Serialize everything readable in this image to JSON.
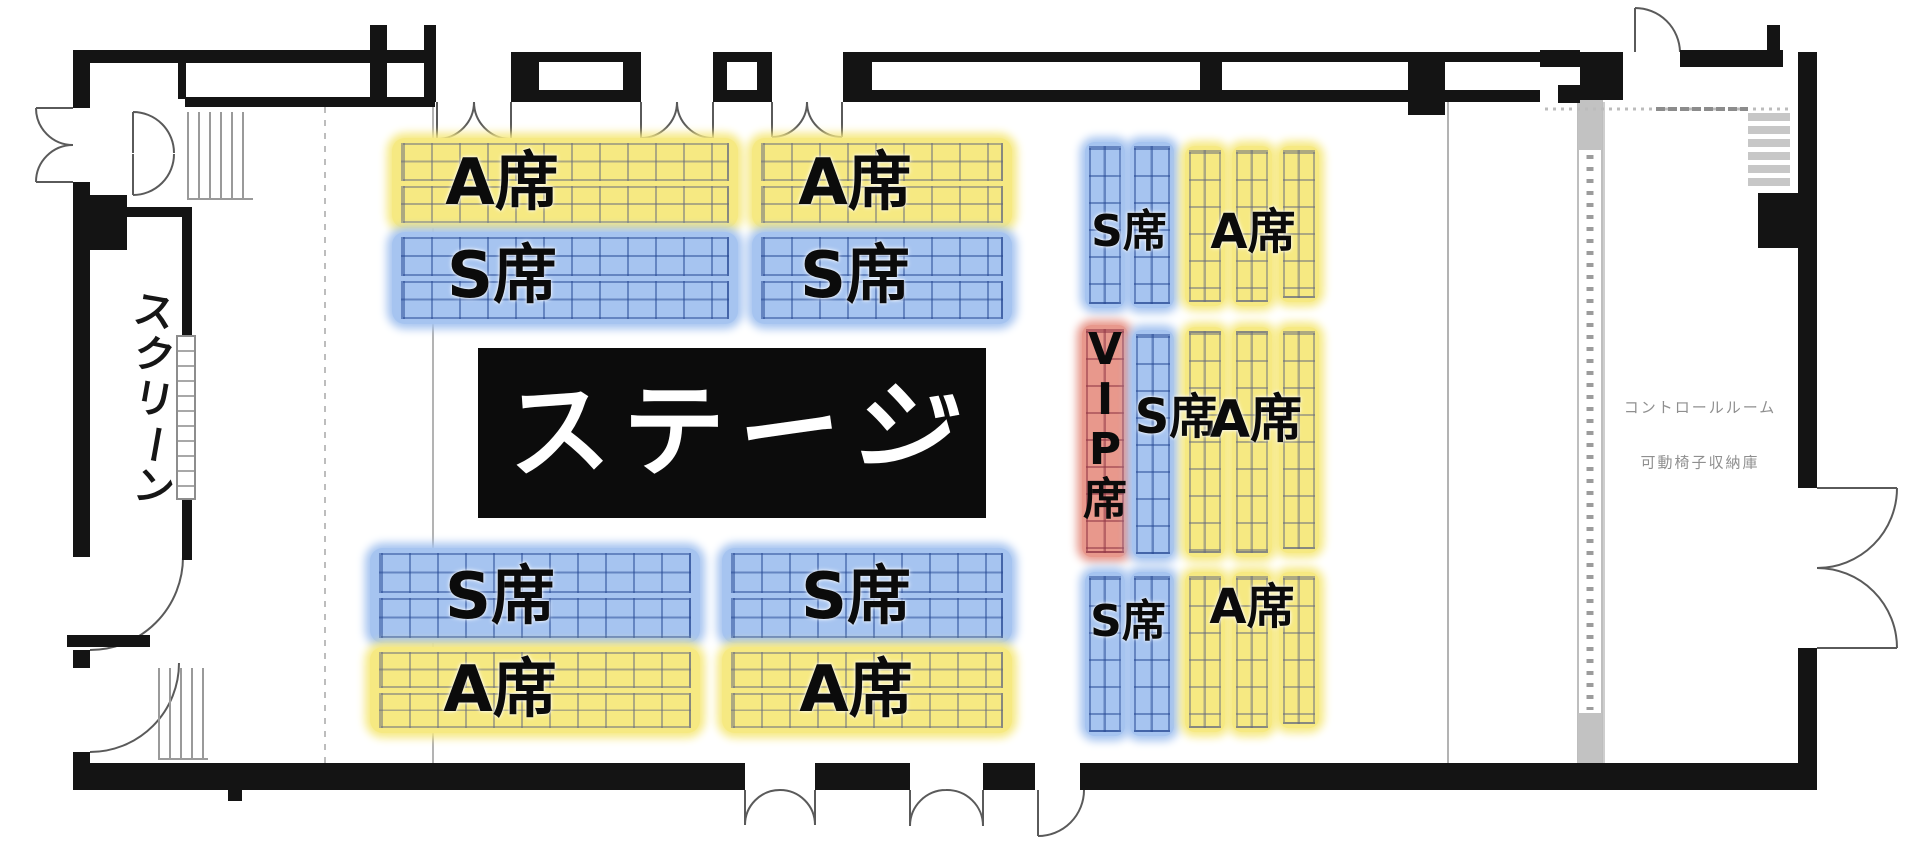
{
  "stage": {
    "label": "ステージ"
  },
  "screen": {
    "label": "スクリーン"
  },
  "control_room": {
    "room_label": "コントロールルーム",
    "storage_label": "可動椅子収納庫"
  },
  "seats": {
    "a_label": "A席",
    "s_label": "S席",
    "vip_label": "VIP席",
    "colors": {
      "a": "#f6e982",
      "s": "#a6c4f0",
      "vip": "#e8988c"
    }
  },
  "zones": [
    {
      "area": "front-upper-left",
      "rows": [
        "A席",
        "S席"
      ]
    },
    {
      "area": "front-upper-right",
      "rows": [
        "A席",
        "S席"
      ]
    },
    {
      "area": "front-lower-left",
      "rows": [
        "S席",
        "A席"
      ]
    },
    {
      "area": "front-lower-right",
      "rows": [
        "S席",
        "A席"
      ]
    },
    {
      "area": "rear-top",
      "columns": [
        "S席",
        "A席"
      ]
    },
    {
      "area": "rear-middle",
      "columns": [
        "VIP席",
        "S席",
        "A席"
      ]
    },
    {
      "area": "rear-bottom",
      "columns": [
        "S席",
        "A席"
      ]
    }
  ]
}
